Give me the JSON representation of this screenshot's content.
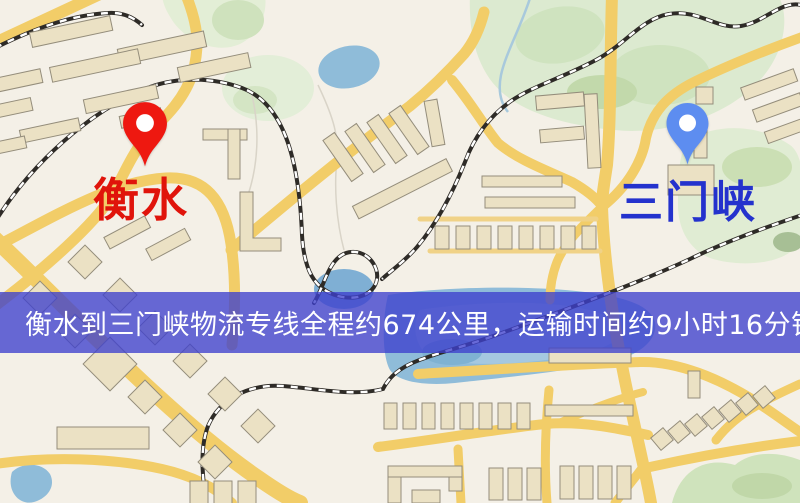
{
  "map": {
    "origin": {
      "name": "衡水",
      "label_color": "#e0140b",
      "pin_color": "#ee1810"
    },
    "destination": {
      "name": "三门峡",
      "label_color": "#2432cd",
      "pin_color": "#5d8df0"
    },
    "style_colors": {
      "land": "#f4f0e7",
      "road": "#f2cd68",
      "building": "#ebe1c4",
      "park": "#dcead0",
      "water": "#8fbcd9",
      "railway": "#2e2b27"
    }
  },
  "banner": {
    "text": "衡水到三门峡物流专线全程约674公里，运输时间约9小时16分钟.",
    "background": "#3e40cd",
    "text_color": "#ffffff"
  },
  "route": {
    "origin": "衡水",
    "destination": "三门峡",
    "distance_text": "约674公里",
    "duration_text": "约9小时16分钟"
  }
}
